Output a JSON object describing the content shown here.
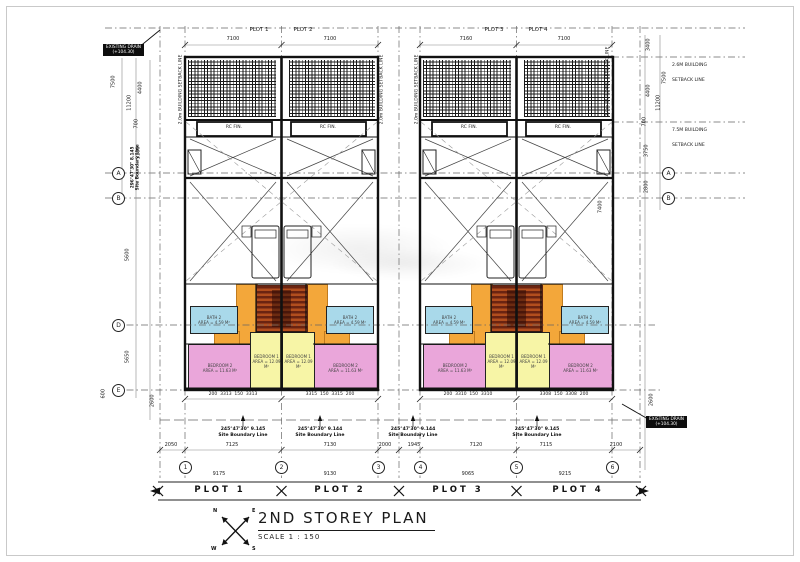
{
  "drawing": {
    "title": "2ND STOREY PLAN",
    "scale": "SCALE 1 : 150",
    "compass": {
      "n": "N",
      "e": "E",
      "s": "S",
      "w": "W"
    }
  },
  "plots": {
    "labels": [
      "PLOT 1",
      "PLOT 2",
      "PLOT 3",
      "PLOT 4"
    ]
  },
  "dims": {
    "top": [
      "7100",
      "7100",
      "7160",
      "7100"
    ],
    "sub": [
      "200  3313  150  3313",
      "3315  150  3315  200",
      "200  3310  150  3310",
      "3308  150  3308  200"
    ],
    "row2": [
      "2050",
      "7125",
      "7130",
      "2000",
      "1945",
      "7120",
      "7115",
      "2100"
    ],
    "row3": [
      "9175",
      "9130",
      "9065",
      "9215"
    ],
    "left": {
      "a": "7500",
      "b": "4400",
      "c": "11200",
      "d": "700",
      "e": "3100",
      "f": "5600",
      "g": "5650",
      "h": "600",
      "i": "2600"
    },
    "right": {
      "a": "3400",
      "b": "7500",
      "c": "4400",
      "d": "11200",
      "e": "700",
      "f": "3750",
      "g": "2800",
      "h": "7400",
      "i": "2600"
    }
  },
  "setbacks": {
    "side": "2.0m BUILDING SETBACK LINE",
    "top_l1": "2.6M BUILDING",
    "top_l2": "SETBACK LINE",
    "front_l1": "7.5M BUILDING",
    "front_l2": "SETBACK LINE"
  },
  "bearings": {
    "b1_l1": "245°47'30\"  9.145",
    "b1_l2": "Site Boundary Line",
    "b2_l1": "245°47'30\"  9.144",
    "b2_l2": "Site Boundary Line",
    "b3_l1": "245°47'30\"  9.144",
    "b3_l2": "Site Boundary Line",
    "b4_l1": "245°47'30\"  9.145",
    "b4_l2": "Site Boundary Line",
    "left_l1": "296°47'30\"  8.145",
    "left_l2": "Site Boundary Line"
  },
  "grid": {
    "rows": [
      "A",
      "B",
      "D",
      "E"
    ],
    "cols": [
      "1",
      "2",
      "3",
      "4",
      "5",
      "6"
    ]
  },
  "rooms": {
    "bedroom1": {
      "name": "BEDROOM 1",
      "area": "AREA = 12.09 M²"
    },
    "bedroom2": {
      "name": "BEDROOM 2",
      "area": "AREA = 11.63 M²"
    },
    "bath2": {
      "name": "BATH 2",
      "area": "AREA = 4.59 M²"
    }
  },
  "labels": {
    "rc_fin": "RC FIN.",
    "chip_l1": "EXISTING DRAIN",
    "chip_l2": "(+104.30)"
  }
}
